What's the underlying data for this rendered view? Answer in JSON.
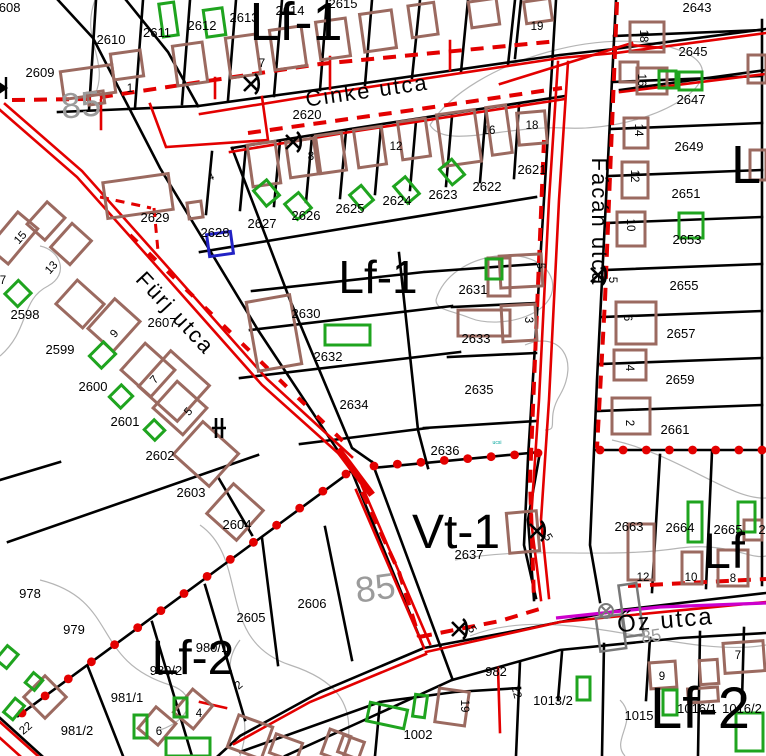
{
  "map": {
    "title": "cadastral zoning map",
    "colors": {
      "background": "#ffffff",
      "parcel_line": "#000000",
      "regulation_red": "#e30000",
      "building_brown": "#9b6a60",
      "building_green": "#1fa41f",
      "building_blue": "#2222c4",
      "building_gray": "#787878",
      "contour_gray": "#b5b5b5",
      "contour_text": "#9b9b9b",
      "magenta_line": "#cc00cc",
      "tiny_teal": "#00a59b"
    },
    "zone_labels": [
      [
        "Lf-1",
        296,
        40,
        54,
        0
      ],
      [
        "Lf-1",
        378,
        293,
        46,
        0
      ],
      [
        "Vt-1",
        456,
        548,
        48,
        0
      ],
      [
        "Lf-2",
        193,
        674,
        48,
        0
      ],
      [
        "Lf-2",
        700,
        728,
        58,
        0
      ],
      [
        "L",
        746,
        183,
        54,
        0
      ],
      [
        "Lf",
        724,
        568,
        50,
        0
      ]
    ],
    "street_labels": [
      [
        "Cinke utca",
        368,
        98,
        22,
        -8
      ],
      [
        "Fürj utca",
        170,
        318,
        22,
        47
      ],
      [
        "Fácán utca",
        592,
        222,
        22,
        90
      ],
      [
        "Őz utca",
        666,
        628,
        24,
        -5
      ]
    ],
    "contour_labels": [
      [
        "85",
        82,
        117,
        36,
        -5
      ],
      [
        "85",
        377,
        600,
        36,
        -8
      ],
      [
        "85",
        652,
        642,
        18,
        -8
      ]
    ],
    "tiny_labels": [
      [
        "ucsi",
        497,
        444,
        5,
        0
      ]
    ],
    "parcel_labels": [
      [
        "2608",
        6,
        12
      ],
      [
        "2609",
        40,
        77
      ],
      [
        "2610",
        111,
        44
      ],
      [
        "2611",
        157,
        37
      ],
      [
        "2612",
        202,
        30
      ],
      [
        "2613",
        244,
        22
      ],
      [
        "2614",
        290,
        15
      ],
      [
        "2615",
        343,
        8
      ],
      [
        "2620",
        307,
        119
      ],
      [
        "2621",
        532,
        174
      ],
      [
        "2622",
        487,
        191
      ],
      [
        "2623",
        443,
        199
      ],
      [
        "2624",
        397,
        205
      ],
      [
        "2625",
        350,
        213
      ],
      [
        "2626",
        306,
        220
      ],
      [
        "2627",
        262,
        228
      ],
      [
        "2628",
        215,
        237
      ],
      [
        "2629",
        155,
        222
      ],
      [
        "2598",
        25,
        319
      ],
      [
        "2599",
        60,
        354
      ],
      [
        "2600",
        93,
        391
      ],
      [
        "2601",
        125,
        426
      ],
      [
        "2602",
        160,
        460
      ],
      [
        "2603",
        191,
        497
      ],
      [
        "2604",
        237,
        529
      ],
      [
        "2605",
        251,
        622
      ],
      [
        "2606",
        312,
        608
      ],
      [
        "2607",
        162,
        327
      ],
      [
        "2630",
        306,
        318
      ],
      [
        "2631",
        473,
        294
      ],
      [
        "2632",
        328,
        361
      ],
      [
        "2633",
        476,
        343
      ],
      [
        "2634",
        354,
        409
      ],
      [
        "2635",
        479,
        394
      ],
      [
        "2636",
        445,
        455
      ],
      [
        "2637",
        469,
        559
      ],
      [
        "2643",
        697,
        12
      ],
      [
        "2645",
        693,
        56
      ],
      [
        "2647",
        691,
        104
      ],
      [
        "2649",
        689,
        151
      ],
      [
        "2651",
        686,
        198
      ],
      [
        "2653",
        687,
        244
      ],
      [
        "2655",
        684,
        290
      ],
      [
        "2657",
        681,
        338
      ],
      [
        "2659",
        680,
        384
      ],
      [
        "2661",
        675,
        434
      ],
      [
        "2663",
        629,
        531
      ],
      [
        "2664",
        680,
        532
      ],
      [
        "2665",
        728,
        534
      ],
      [
        "2",
        762,
        534
      ],
      [
        "978",
        30,
        598
      ],
      [
        "979",
        74,
        634
      ],
      [
        "980/1",
        212,
        652
      ],
      [
        "980/2",
        166,
        675
      ],
      [
        "981/1",
        127,
        702
      ],
      [
        "981/2",
        77,
        735
      ],
      [
        "982",
        496,
        676
      ],
      [
        "1002",
        418,
        739
      ],
      [
        "1013/2",
        553,
        705
      ],
      [
        "1015",
        639,
        720
      ],
      [
        "1016/1",
        697,
        713
      ],
      [
        "1016/2",
        742,
        713
      ]
    ],
    "house_numbers": [
      [
        "1",
        130,
        92,
        0
      ],
      [
        "7",
        262,
        67,
        0
      ],
      [
        "4",
        212,
        180,
        -20
      ],
      [
        "8",
        311,
        160,
        0
      ],
      [
        "12",
        396,
        150,
        0
      ],
      [
        "16",
        489,
        134,
        0
      ],
      [
        "18",
        532,
        129,
        0
      ],
      [
        "19",
        537,
        30,
        0
      ],
      [
        "18",
        640,
        36,
        90
      ],
      [
        "16",
        638,
        80,
        90
      ],
      [
        "14",
        635,
        130,
        90
      ],
      [
        "12",
        631,
        176,
        90
      ],
      [
        "10",
        627,
        225,
        90
      ],
      [
        "5",
        609,
        280,
        90
      ],
      [
        "6",
        624,
        318,
        90
      ],
      [
        "4",
        626,
        368,
        90
      ],
      [
        "2",
        626,
        423,
        90
      ],
      [
        "3",
        525,
        320,
        90
      ],
      [
        "5",
        537,
        266,
        90
      ],
      [
        "15",
        23,
        240,
        -48
      ],
      [
        "13",
        54,
        270,
        -48
      ],
      [
        "7",
        3,
        284,
        0
      ],
      [
        "9",
        117,
        336,
        -48
      ],
      [
        "7",
        157,
        382,
        -48
      ],
      [
        "5",
        191,
        414,
        -48
      ],
      [
        "22",
        28,
        731,
        -40
      ],
      [
        "2",
        241,
        688,
        -40
      ],
      [
        "4",
        199,
        717,
        0
      ],
      [
        "6",
        159,
        735,
        0
      ],
      [
        "12",
        643,
        581,
        0
      ],
      [
        "10",
        691,
        581,
        0
      ],
      [
        "8",
        733,
        582,
        0
      ],
      [
        "7",
        738,
        659,
        0
      ],
      [
        "9",
        662,
        680,
        0
      ],
      [
        "19",
        461,
        706,
        90
      ],
      [
        "22",
        513,
        693,
        75
      ],
      [
        "5",
        545,
        539,
        60
      ],
      [
        "5",
        469,
        631,
        60
      ]
    ],
    "symbols": {
      "x_marks": [
        [
          251,
          84
        ],
        [
          293,
          142
        ],
        [
          598,
          275
        ],
        [
          537,
          531
        ],
        [
          459,
          629
        ]
      ],
      "valve_marks": [
        [
          6,
          88
        ]
      ],
      "bar_marks": [
        [
          222,
          428
        ]
      ],
      "gray_cross_marks": [
        [
          606,
          611
        ]
      ]
    },
    "dot_lines": [
      [
        22,
        713,
        346,
        474,
        15
      ],
      [
        374,
        466,
        538,
        453,
        8
      ],
      [
        600,
        450,
        762,
        450,
        8
      ]
    ],
    "buildings": {
      "brown": [
        [
          62,
          68,
          52,
          28,
          -8
        ],
        [
          88,
          92,
          16,
          12,
          -8
        ],
        [
          112,
          52,
          30,
          26,
          -8
        ],
        [
          175,
          44,
          30,
          40,
          -8
        ],
        [
          228,
          36,
          30,
          40,
          -8
        ],
        [
          272,
          28,
          32,
          40,
          -8
        ],
        [
          318,
          20,
          30,
          38,
          -8
        ],
        [
          362,
          12,
          32,
          38,
          -8
        ],
        [
          410,
          4,
          26,
          32,
          -8
        ],
        [
          470,
          0,
          28,
          26,
          -8
        ],
        [
          525,
          0,
          26,
          22,
          -8
        ],
        [
          518,
          112,
          28,
          32,
          -5
        ],
        [
          630,
          22,
          34,
          30,
          0
        ],
        [
          620,
          62,
          18,
          20,
          0
        ],
        [
          637,
          68,
          30,
          26,
          0
        ],
        [
          624,
          118,
          24,
          30,
          0
        ],
        [
          622,
          162,
          26,
          36,
          0
        ],
        [
          617,
          212,
          28,
          34,
          0
        ],
        [
          748,
          55,
          18,
          28,
          0
        ],
        [
          750,
          150,
          16,
          30,
          0
        ],
        [
          250,
          143,
          28,
          42,
          -8
        ],
        [
          288,
          140,
          28,
          36,
          -8
        ],
        [
          318,
          134,
          26,
          38,
          -8
        ],
        [
          356,
          128,
          28,
          38,
          -8
        ],
        [
          400,
          120,
          28,
          38,
          -8
        ],
        [
          440,
          112,
          38,
          52,
          -8
        ],
        [
          489,
          106,
          20,
          48,
          -8
        ],
        [
          105,
          178,
          66,
          36,
          -8
        ],
        [
          188,
          202,
          14,
          16,
          -8
        ],
        [
          252,
          298,
          44,
          70,
          -10
        ],
        [
          488,
          258,
          22,
          38,
          0
        ],
        [
          458,
          310,
          52,
          26,
          0
        ],
        [
          0,
          215,
          26,
          46,
          40
        ],
        [
          34,
          206,
          24,
          30,
          42
        ],
        [
          58,
          228,
          26,
          32,
          42
        ],
        [
          62,
          288,
          36,
          32,
          42
        ],
        [
          97,
          305,
          34,
          40,
          42
        ],
        [
          128,
          352,
          40,
          36,
          42
        ],
        [
          160,
          390,
          40,
          36,
          42
        ],
        [
          148,
          362,
          52,
          48,
          42
        ],
        [
          182,
          432,
          48,
          44,
          42
        ],
        [
          215,
          492,
          40,
          40,
          42
        ],
        [
          30,
          682,
          30,
          30,
          45
        ],
        [
          500,
          255,
          42,
          32,
          -3
        ],
        [
          502,
          305,
          34,
          36,
          -3
        ],
        [
          616,
          302,
          40,
          42,
          0
        ],
        [
          614,
          350,
          32,
          30,
          0
        ],
        [
          612,
          398,
          38,
          36,
          0
        ],
        [
          628,
          524,
          26,
          56,
          0
        ],
        [
          682,
          552,
          20,
          32,
          0
        ],
        [
          718,
          550,
          30,
          36,
          0
        ],
        [
          744,
          520,
          18,
          20,
          0
        ],
        [
          508,
          512,
          30,
          40,
          -5
        ],
        [
          232,
          720,
          36,
          34,
          20
        ],
        [
          272,
          738,
          28,
          20,
          20
        ],
        [
          325,
          732,
          22,
          26,
          20
        ],
        [
          340,
          738,
          22,
          18,
          20
        ],
        [
          437,
          690,
          30,
          34,
          8
        ],
        [
          650,
          662,
          26,
          26,
          -4
        ],
        [
          688,
          688,
          30,
          14,
          -4
        ],
        [
          724,
          642,
          40,
          30,
          -4
        ],
        [
          700,
          660,
          18,
          24,
          -4
        ],
        [
          180,
          694,
          26,
          30,
          40
        ],
        [
          144,
          712,
          26,
          28,
          40
        ]
      ],
      "green": [
        [
          161,
          3,
          15,
          33,
          -8
        ],
        [
          205,
          9,
          19,
          27,
          -8
        ],
        [
          659,
          71,
          17,
          17,
          0
        ],
        [
          679,
          72,
          23,
          18,
          0
        ],
        [
          679,
          213,
          24,
          25,
          0
        ],
        [
          9,
          284,
          18,
          19,
          45
        ],
        [
          94,
          345,
          17,
          20,
          45
        ],
        [
          113,
          388,
          16,
          17,
          45
        ],
        [
          147,
          423,
          15,
          14,
          45
        ],
        [
          258,
          183,
          17,
          20,
          -40
        ],
        [
          289,
          196,
          18,
          20,
          -40
        ],
        [
          354,
          188,
          15,
          19,
          -40
        ],
        [
          399,
          179,
          15,
          22,
          -40
        ],
        [
          444,
          162,
          16,
          20,
          -40
        ],
        [
          325,
          325,
          45,
          20,
          0
        ],
        [
          486,
          259,
          16,
          20,
          0
        ],
        [
          577,
          677,
          13,
          23,
          0
        ],
        [
          663,
          690,
          14,
          25,
          0
        ],
        [
          736,
          713,
          27,
          38,
          0
        ],
        [
          688,
          502,
          14,
          40,
          0
        ],
        [
          738,
          502,
          17,
          30,
          0
        ],
        [
          368,
          706,
          38,
          19,
          12
        ],
        [
          414,
          695,
          12,
          22,
          8
        ],
        [
          0,
          648,
          14,
          18,
          40
        ],
        [
          28,
          675,
          12,
          13,
          40
        ],
        [
          8,
          700,
          12,
          18,
          40
        ],
        [
          134,
          715,
          13,
          23,
          0
        ],
        [
          174,
          698,
          13,
          19,
          0
        ],
        [
          166,
          738,
          44,
          18,
          0
        ]
      ],
      "blue": [
        [
          208,
          233,
          24,
          22,
          -8
        ]
      ],
      "gray": [
        [
          598,
          616,
          26,
          34,
          -8
        ],
        [
          622,
          584,
          18,
          52,
          -8
        ]
      ]
    }
  }
}
